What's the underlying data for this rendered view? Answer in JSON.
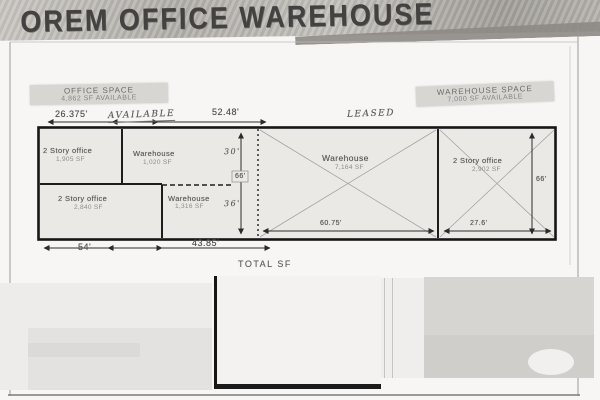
{
  "banner": {
    "title": "OREM OFFICE WAREHOUSE"
  },
  "space_labels": {
    "office": {
      "title": "OFFICE SPACE",
      "subtitle": "4,862 SF AVAILABLE"
    },
    "warehouse": {
      "title": "WAREHOUSE SPACE",
      "subtitle": "7,000 SF AVAILABLE"
    }
  },
  "handwritten": {
    "available": "AVAILABLE",
    "leased": "LEASED"
  },
  "rooms": {
    "office_nw": {
      "name": "2 Story office",
      "area": "1,905 SF"
    },
    "warehouse_n": {
      "name": "Warehouse",
      "area": "1,020 SF"
    },
    "office_sw": {
      "name": "2 Story office",
      "area": "2,840 SF"
    },
    "warehouse_s": {
      "name": "Warehouse",
      "area": "1,316 SF"
    },
    "warehouse_main": {
      "name": "Warehouse",
      "area": "7,164 SF"
    },
    "office_e": {
      "name": "2 Story office",
      "area": "2,902 SF"
    }
  },
  "dims": {
    "top_seg1": "26.375'",
    "top_seg2": "52.48'",
    "left_upper": "30'",
    "left_total": "66'",
    "left_lower": "36'",
    "right_height": "66'",
    "main_width": "60.75'",
    "right_width": "27.6'",
    "bottom_seg1": "54'",
    "bottom_seg2": "43.85'"
  },
  "footer": {
    "total_sf": "TOTAL SF"
  }
}
